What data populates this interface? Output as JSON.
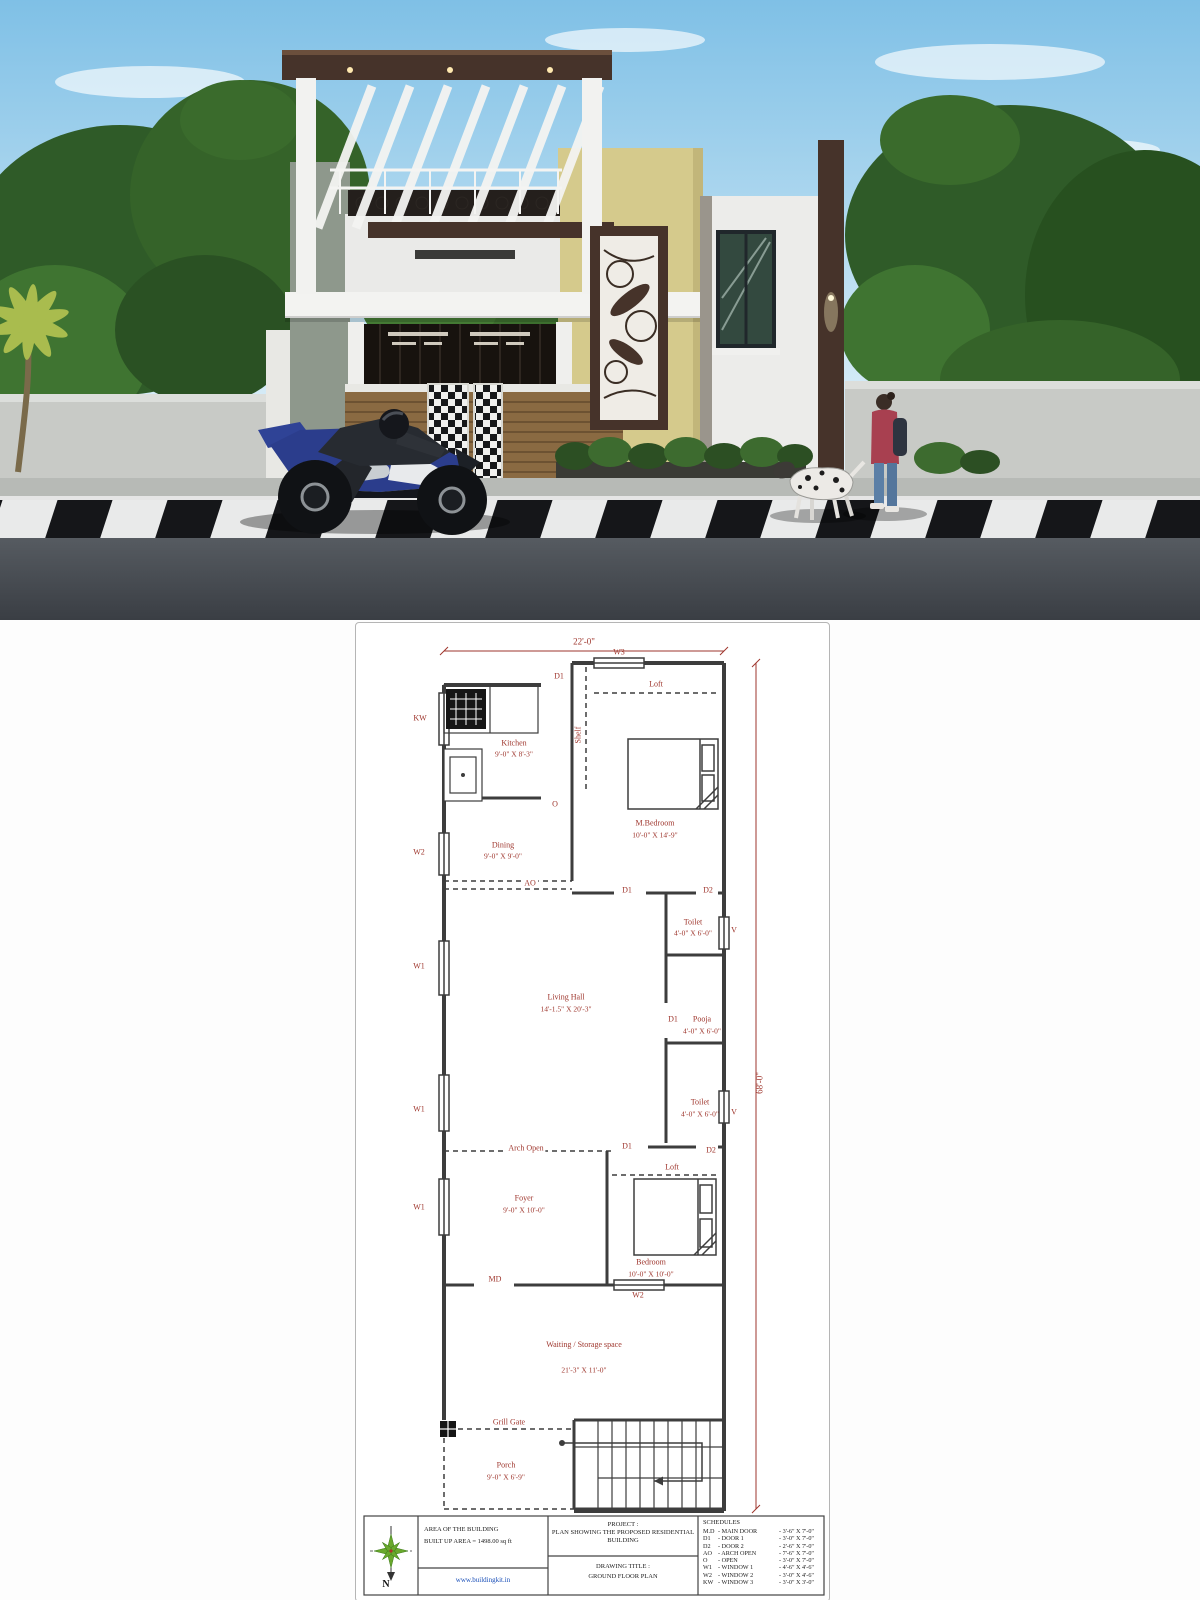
{
  "render": {
    "scene": "3d-elevation-of-modern-residential-house-with-pergola-motorcycle-rider-pedestrian-and-dalmatian-dog",
    "colors": {
      "sky_top": "#7fc0e6",
      "sky_bottom": "#e8f4fa",
      "foliage_dark": "#2f5b28",
      "foliage_light": "#5f9b3f",
      "wall_gray": "#8e988c",
      "accent_yellow": "#d5ca8c",
      "accent_brown": "#46332a",
      "facade_white": "#efefed",
      "road": "#474c52",
      "curb_black": "#151619",
      "curb_white": "#e9eaea"
    }
  },
  "plan": {
    "line_color": "#3d3d3d",
    "label_color": "#9e352c",
    "dims": {
      "width": "22'-0\"",
      "height": "68'-0\""
    },
    "markers": {
      "d1": "D1",
      "d2": "D2",
      "w1": "W1",
      "w2": "W2",
      "w3": "W3",
      "kw": "KW",
      "v": "V",
      "o": "O",
      "ao": "AO",
      "md": "MD",
      "loft": "Loft",
      "shelf": "Shelf",
      "arch_open": "Arch Open",
      "grill_gate": "Grill Gate"
    },
    "rooms": {
      "kitchen": {
        "name": "Kitchen",
        "size": "9'-0\" X 8'-3\""
      },
      "dining": {
        "name": "Dining",
        "size": "9'-0\" X 9'-0\""
      },
      "m_bedroom": {
        "name": "M.Bedroom",
        "size": "10'-0\" X 14'-9\""
      },
      "living_hall": {
        "name": "Living Hall",
        "size": "14'-1.5\" X 20'-3\""
      },
      "toilet_top": {
        "name": "Toilet",
        "size": "4'-0\" X 6'-0\""
      },
      "pooja": {
        "name": "Pooja",
        "size": "4'-0\" X 6'-0\""
      },
      "toilet_bottom": {
        "name": "Toilet",
        "size": "4'-0\" X 6'-0\""
      },
      "foyer": {
        "name": "Foyer",
        "size": "9'-0\" X 10'-0\""
      },
      "bedroom": {
        "name": "Bedroom",
        "size": "10'-0\" X 10'-0\""
      },
      "waiting": {
        "name": "Waiting / Storage space",
        "size": "21'-3\" X 11'-0\""
      },
      "porch": {
        "name": "Porch",
        "size": "9'-0\" X 6'-9\""
      }
    },
    "title_block": {
      "north_label": "N",
      "area_line1": "AREA OF THE BUILDING",
      "area_line2": "BUILT UP AREA  = 1498.00 sq ft",
      "website": "www.buildingkit.in",
      "project_label": "PROJECT :",
      "project_text": "PLAN SHOWING THE PROPOSED RESIDENTIAL BUILDING",
      "drawing_title_label": "DRAWING TITLE :",
      "drawing_title_text": "GROUND FLOOR PLAN",
      "schedules_title": "SCHEDULES",
      "schedules": [
        {
          "code": "M.D",
          "name": "MAIN DOOR",
          "size": "3'-6\" X 7'-0\""
        },
        {
          "code": "D1",
          "name": "DOOR 1",
          "size": "3'-0\" X 7'-0\""
        },
        {
          "code": "D2",
          "name": "DOOR 2",
          "size": "2'-6\" X 7'-0\""
        },
        {
          "code": "AO",
          "name": "ARCH OPEN",
          "size": "7'-6\" X 7'-0\""
        },
        {
          "code": "O",
          "name": "OPEN",
          "size": "3'-0\" X 7'-0\""
        },
        {
          "code": "W1",
          "name": "WINDOW 1",
          "size": "4'-6\" X 4'-6\""
        },
        {
          "code": "W2",
          "name": "WINDOW 2",
          "size": "3'-0\" X 4'-6\""
        },
        {
          "code": "KW",
          "name": "WINDOW 3",
          "size": "3'-0\" X 3'-0\""
        }
      ]
    }
  }
}
